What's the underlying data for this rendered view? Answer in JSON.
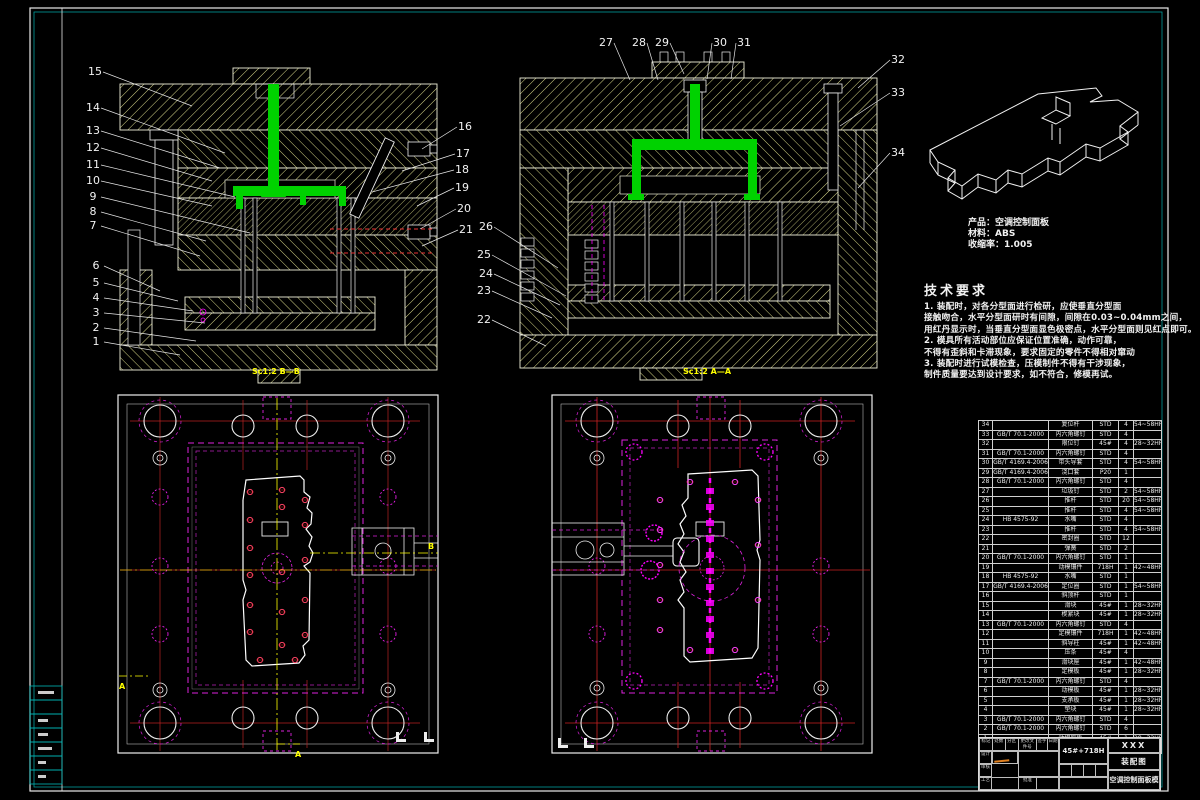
{
  "colors": {
    "background": "#000000",
    "outline_white": "#f0f0e6",
    "hatch_yellow": "#d8d88a",
    "runner_green": "#00d200",
    "magenta": "#ff00ff",
    "centerline_yellow": "#ffff00",
    "centerline_red": "#cc2222",
    "frame_cyan": "#00c0c0",
    "signature_orange": "#e08020"
  },
  "balloons": [
    "1",
    "2",
    "3",
    "4",
    "5",
    "6",
    "7",
    "8",
    "9",
    "10",
    "11",
    "12",
    "13",
    "14",
    "15",
    "16",
    "17",
    "18",
    "19",
    "20",
    "21",
    "22",
    "23",
    "24",
    "25",
    "26",
    "27",
    "28",
    "29",
    "30",
    "31",
    "32",
    "33",
    "34"
  ],
  "views": {
    "bb_label": "Sc1:2  B—B",
    "aa_label": "Sc1:2  A—A"
  },
  "sections": {
    "a": "A",
    "b": "B"
  },
  "product": {
    "line1": "产品：空调控制面板",
    "line2": "材料：ABS",
    "line3": "收缩率：1.005"
  },
  "tech": {
    "title": "技术要求",
    "lines": [
      "1. 装配时，对各分型面进行检研，应使垂直分型面",
      "接触吻合，水平分型面研时有间隙，间隙在0.03~0.04mm之间，",
      "用红丹显示时，当垂直分型面显色极密点，水平分型面则见红点即可。",
      "2. 模具所有活动部位应保证位置准确，动作可靠，",
      "不得有歪斜和卡滞现象，要求固定的零件不得相对窜动",
      "3. 装配时进行试模检查，压模制件不得有干涉现象，",
      "制件质量要达到设计要求，如不符合，修模再试。"
    ]
  },
  "bom": {
    "headers": [
      "序号",
      "代号",
      "名称",
      "材料",
      "数量",
      "备注"
    ],
    "rows": [
      [
        "34",
        "",
        "复位杆",
        "STD",
        "4",
        "54~58HRC"
      ],
      [
        "33",
        "GB/T 70.1-2000",
        "内六角螺钉",
        "STD",
        "4",
        ""
      ],
      [
        "32",
        "",
        "限位钉",
        "45#",
        "4",
        "28~32HRC"
      ],
      [
        "31",
        "GB/T 70.1-2000",
        "内六角螺钉",
        "STD",
        "4",
        ""
      ],
      [
        "30",
        "GB/T 4169.4-2006",
        "带头导套",
        "STD",
        "4",
        "54~58HRC"
      ],
      [
        "29",
        "GB/T 4169.4-2006",
        "浇口套",
        "P20",
        "1",
        ""
      ],
      [
        "28",
        "GB/T 70.1-2000",
        "内六角螺钉",
        "STD",
        "4",
        ""
      ],
      [
        "27",
        "",
        "垃圾钉",
        "STD",
        "2",
        "54~58HRC"
      ],
      [
        "26",
        "",
        "推杆",
        "STD",
        "20",
        "54~58HRC"
      ],
      [
        "25",
        "",
        "推杆",
        "STD",
        "4",
        "54~58HRC"
      ],
      [
        "24",
        "HB 4575-92",
        "水嘴",
        "STD",
        "4",
        ""
      ],
      [
        "23",
        "",
        "推杆",
        "STD",
        "4",
        "54~58HRC"
      ],
      [
        "22",
        "",
        "密封圈",
        "STD",
        "12",
        ""
      ],
      [
        "21",
        "",
        "弹簧",
        "STD",
        "2",
        ""
      ],
      [
        "20",
        "GB/T 70.1-2000",
        "内六角螺钉",
        "STD",
        "1",
        ""
      ],
      [
        "19",
        "",
        "动模镶件",
        "718H",
        "1",
        "42~48HRC"
      ],
      [
        "18",
        "HB 4575-92",
        "水嘴",
        "STD",
        "1",
        ""
      ],
      [
        "17",
        "GB/T 4169.4-2006",
        "定位圈",
        "STD",
        "1",
        "54~58HRC"
      ],
      [
        "16",
        "",
        "斜顶杆",
        "STD",
        "1",
        ""
      ],
      [
        "15",
        "",
        "滑块",
        "45#",
        "1",
        "28~32HRC"
      ],
      [
        "14",
        "",
        "楔紧块",
        "45#",
        "1",
        "28~32HRC"
      ],
      [
        "13",
        "GB/T 70.1-2000",
        "内六角螺钉",
        "STD",
        "4",
        ""
      ],
      [
        "12",
        "",
        "定模镶件",
        "718H",
        "1",
        "42~48HRC"
      ],
      [
        "11",
        "",
        "斜导柱",
        "45#",
        "1",
        "42~48HRC"
      ],
      [
        "10",
        "",
        "压条",
        "45#",
        "4",
        ""
      ],
      [
        "9",
        "",
        "滑块座",
        "45#",
        "1",
        "42~48HRC"
      ],
      [
        "8",
        "",
        "定模板",
        "45#",
        "1",
        "28~32HRC"
      ],
      [
        "7",
        "GB/T 70.1-2000",
        "内六角螺钉",
        "STD",
        "4",
        ""
      ],
      [
        "6",
        "",
        "动模板",
        "45#",
        "1",
        "28~32HRC"
      ],
      [
        "5",
        "",
        "支承板",
        "45#",
        "1",
        "28~32HRC"
      ],
      [
        "4",
        "",
        "垫块",
        "45#",
        "1",
        "28~32HRC"
      ],
      [
        "3",
        "GB/T 70.1-2000",
        "内六角螺钉",
        "STD",
        "4",
        ""
      ],
      [
        "2",
        "GB/T 70.1-2000",
        "内六角螺钉",
        "STD",
        "6",
        ""
      ],
      [
        "1",
        "",
        "动模座板",
        "45#",
        "1",
        "28~32HRC"
      ]
    ]
  },
  "title_block": {
    "material": "45#+718H",
    "code": "XXX",
    "doc_type": "装配图",
    "title": "空调控制面板模",
    "small_labels": [
      "标记",
      "处数",
      "分区",
      "更改文件号",
      "签字",
      "日期"
    ],
    "side_labels": [
      "设计",
      "审核",
      "工艺",
      "批准"
    ]
  }
}
